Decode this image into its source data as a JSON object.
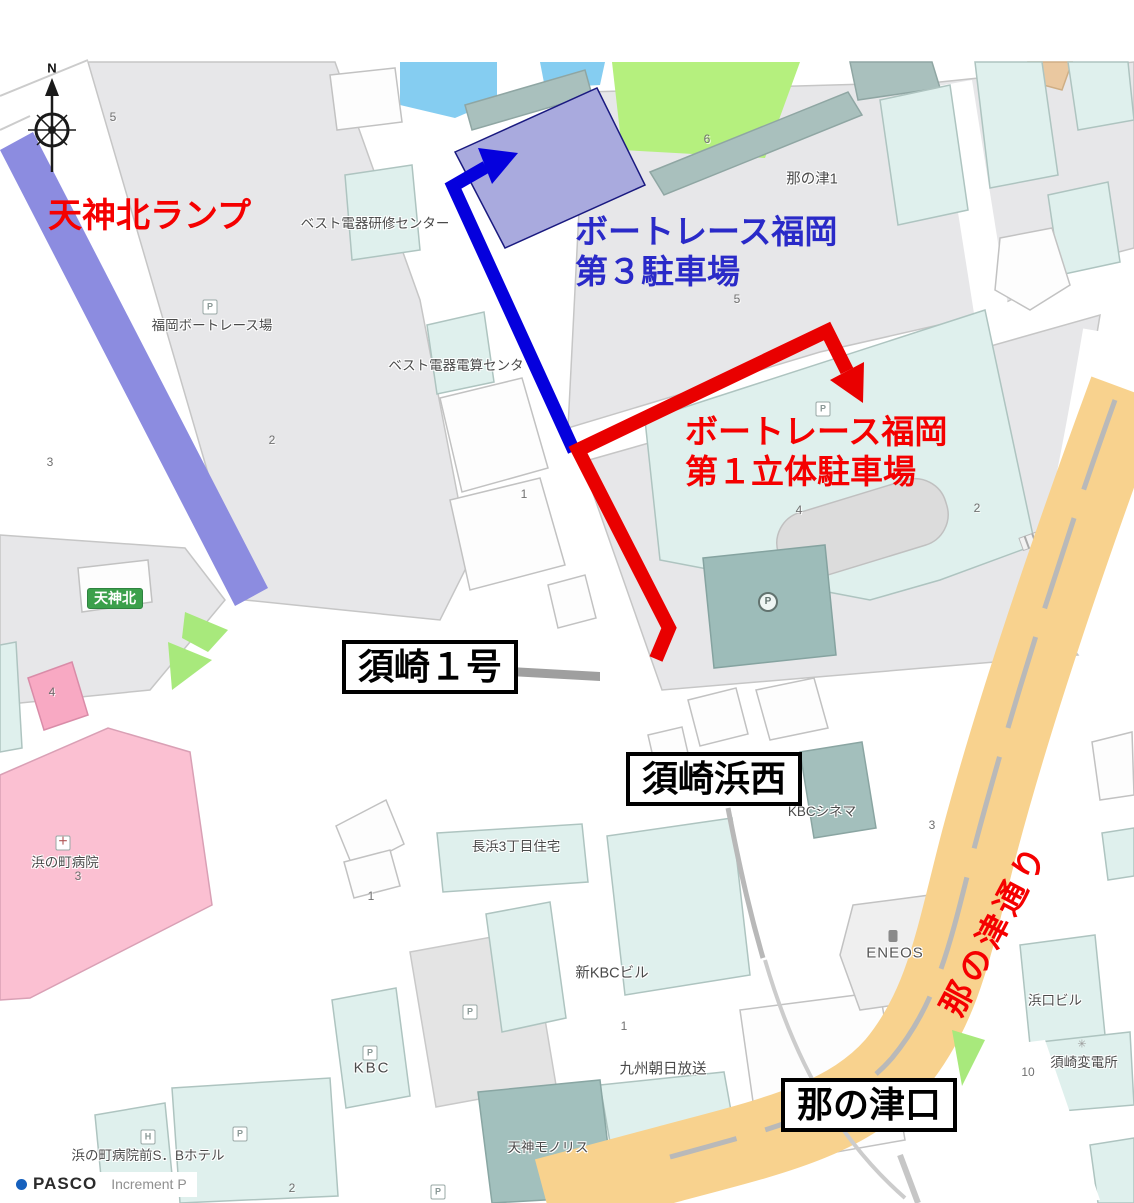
{
  "annotations": {
    "ramp": "天神北ランプ",
    "parking3_line1": "ボートレース福岡",
    "parking3_line2": "第３駐車場",
    "parking1_line1": "ボートレース福岡",
    "parking1_line2": "第１立体駐車場",
    "nanotsu_dori": "那の津通り"
  },
  "signs": {
    "susaki1": "須崎１号",
    "susaki_hamanishi": "須崎浜西",
    "nanotsu_guchi": "那の津口",
    "tenjin_kita": "天神北"
  },
  "places": {
    "boat_race_stadium": "福岡ボートレース場",
    "best_denki_training": "ベスト電器研修センター",
    "best_denki_computing": "ベスト電器電算センタ",
    "nanotsu1": "那の津1",
    "kbc_cinema": "KBCシネマ",
    "nagahama_housing": "長浜3丁目住宅",
    "shin_kbc": "新KBCビル",
    "kbc": "KBC",
    "kyushu_asahi": "九州朝日放送",
    "tenjin_monolith": "天神モノリス",
    "hamanomachi_hospital": "浜の町病院",
    "eneos": "ENEOS",
    "hamaguchi_bldg": "浜口ビル",
    "susaki_substation": "須崎変電所",
    "sb_hotel": "浜の町病院前S．Bホテル"
  },
  "icons": {
    "parking": "P",
    "hospital_cross": "＋",
    "hotel": "H",
    "gear": "✳",
    "north": "N"
  },
  "block_numbers": [
    "5",
    "2",
    "3",
    "4",
    "3",
    "6",
    "5",
    "1",
    "4",
    "2",
    "3",
    "1",
    "1",
    "10",
    "2"
  ],
  "attribution": {
    "brand": "PASCO",
    "provider": "Increment P"
  },
  "colors": {
    "route_red": "#e90000",
    "route_blue": "#0500dd",
    "text_red": "#f50000",
    "text_blue": "#2a2ac8",
    "parking_highlight": "#a9aade",
    "expressway": "#8c8ce0",
    "road_orange": "#f8d28e",
    "sign_green": "#3ba04b",
    "water": "#85cdf1",
    "field_green": "#b5f07e"
  }
}
